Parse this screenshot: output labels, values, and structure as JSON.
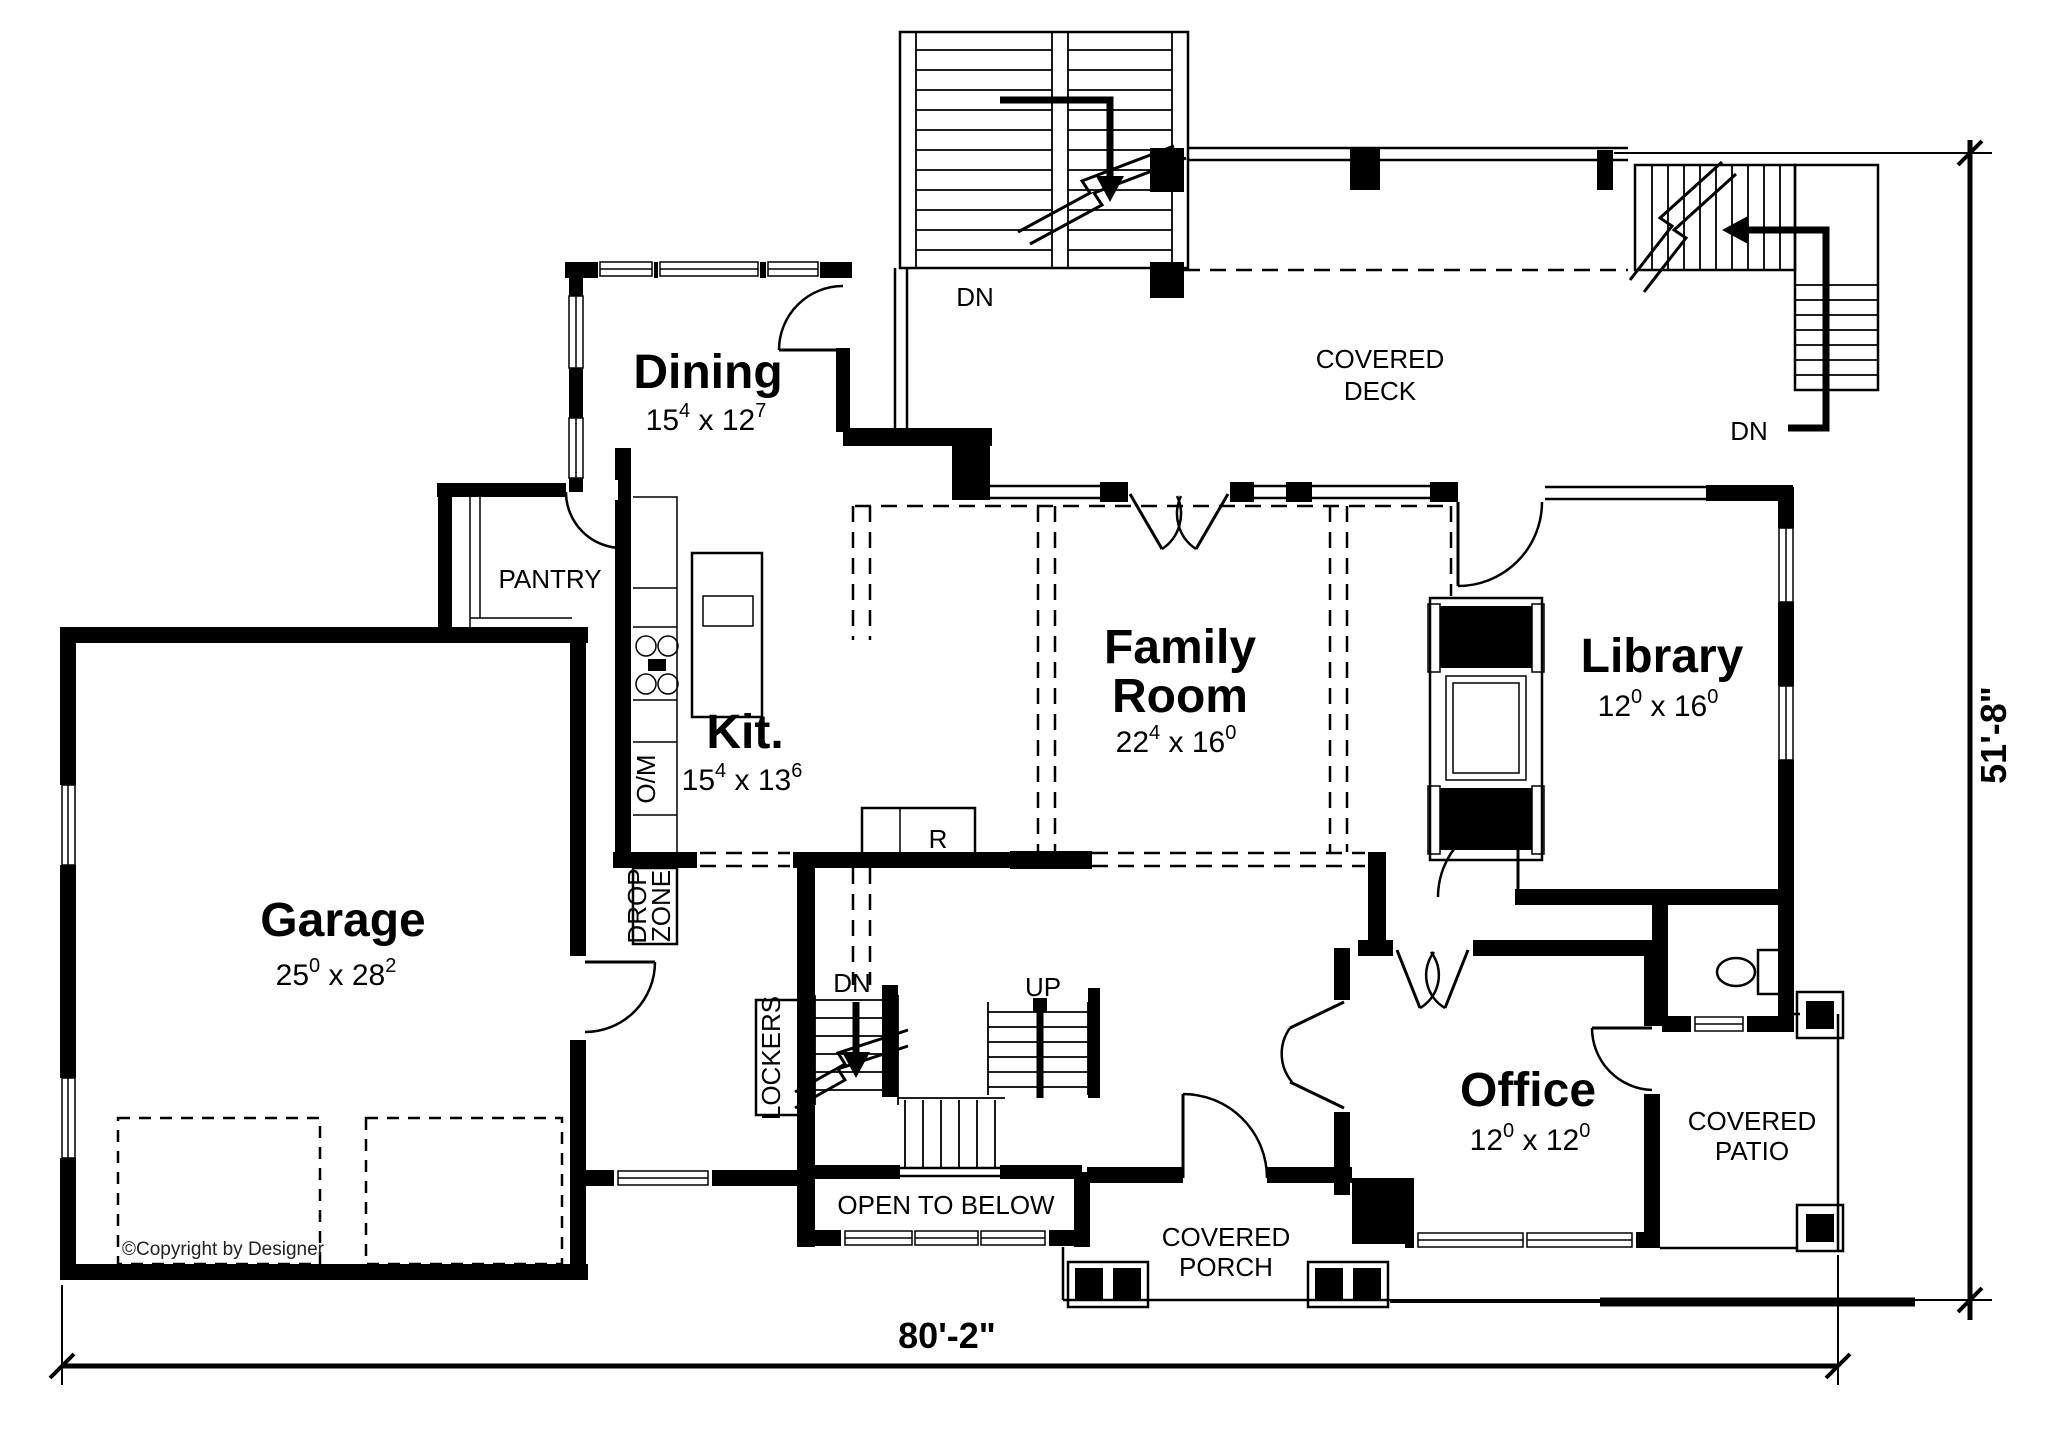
{
  "rooms": {
    "dining": {
      "label": "Dining",
      "dim": {
        "a": "15",
        "b": "4",
        "c": " x 12",
        "d": "7"
      }
    },
    "kitchen": {
      "label": "Kit.",
      "dim": {
        "a": "15",
        "b": "4",
        "c": " x 13",
        "d": "6"
      }
    },
    "family_room": {
      "line1": "Family",
      "line2": "Room",
      "dim": {
        "a": "22",
        "b": "4",
        "c": " x 16",
        "d": "0"
      }
    },
    "library": {
      "label": "Library",
      "dim": {
        "a": "12",
        "b": "0",
        "c": " x 16",
        "d": "0"
      }
    },
    "garage": {
      "label": "Garage",
      "dim": {
        "a": "25",
        "b": "0",
        "c": " x 28",
        "d": "2"
      }
    },
    "office": {
      "label": "Office",
      "dim": {
        "a": "12",
        "b": "0",
        "c": " x 12",
        "d": "0"
      }
    },
    "pantry": {
      "label": "PANTRY"
    }
  },
  "areas": {
    "covered_deck": {
      "line1": "COVERED",
      "line2": "DECK"
    },
    "covered_patio": {
      "line1": "COVERED",
      "line2": "PATIO"
    },
    "covered_porch": {
      "line1": "COVERED",
      "line2": "PORCH"
    },
    "open_to_below": {
      "label": "OPEN TO BELOW"
    }
  },
  "annotations": {
    "drop_zone_line1": "DROP",
    "drop_zone_line2": "ZONE",
    "lockers": "LOCKERS",
    "oven_microwave": "O/M",
    "refrigerator": "R",
    "dn_deck_left": "DN",
    "dn_deck_right": "DN",
    "dn_main": "DN",
    "up_main": "UP",
    "copyright": "©Copyright by Designer"
  },
  "dimensions": {
    "overall_width": "80'-2\"",
    "overall_height": "51'-8\""
  }
}
